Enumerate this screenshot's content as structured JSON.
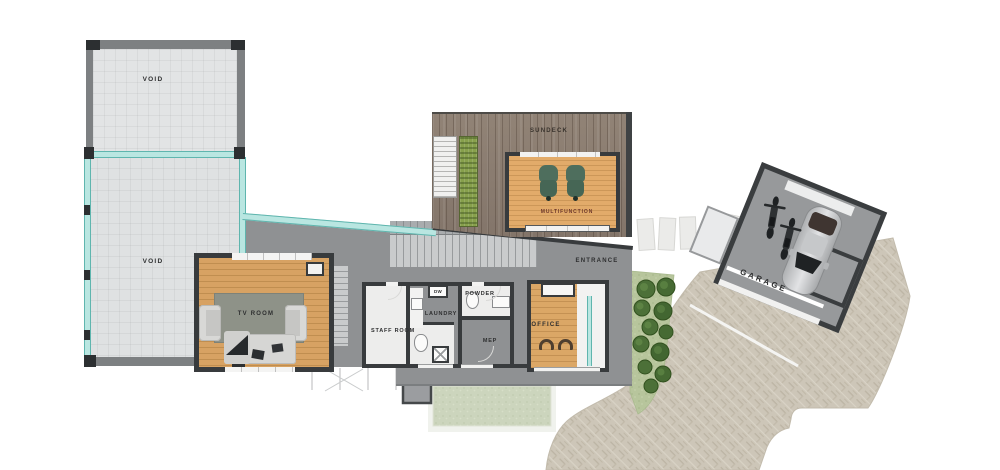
{
  "labels": {
    "void_upper": "VOID",
    "void_lower": "VOID",
    "tv_room": "TV ROOM",
    "staff_room": "STAFF ROOM",
    "laundry": "LAUNDRY",
    "dishwasher": "DW",
    "powder": "POWDER",
    "mep": "MEP",
    "office": "OFFICE",
    "entrance": "ENTRANCE",
    "sundeck": "SUNDECK",
    "multifunction": "MULTIFUNCTION",
    "garage": "GARAGE"
  },
  "colors": {
    "wall_dark": "#383b3d",
    "wall_gray": "#7d8082",
    "building_gray": "#8f9193",
    "void_fill": "#e2e4e5",
    "wood_floor": "#d7a263",
    "deck_wood": "#8e8074",
    "glass_teal": "#b9e6e1",
    "rug": "#8e9288",
    "sofa": "#d8d8d6",
    "lounge_chair_green": "#4e6e5d",
    "driveway_paving": "#cdc6b8",
    "lawn": "#ccd5bd",
    "grass": "#b7c59c",
    "bush_green": "#4c7038",
    "planter_green": "#87a04c",
    "stone": "#ebebe9",
    "garage_floor": "#97999b",
    "label_text": "#2e2f30",
    "multifunction_label": "#6d372b"
  }
}
